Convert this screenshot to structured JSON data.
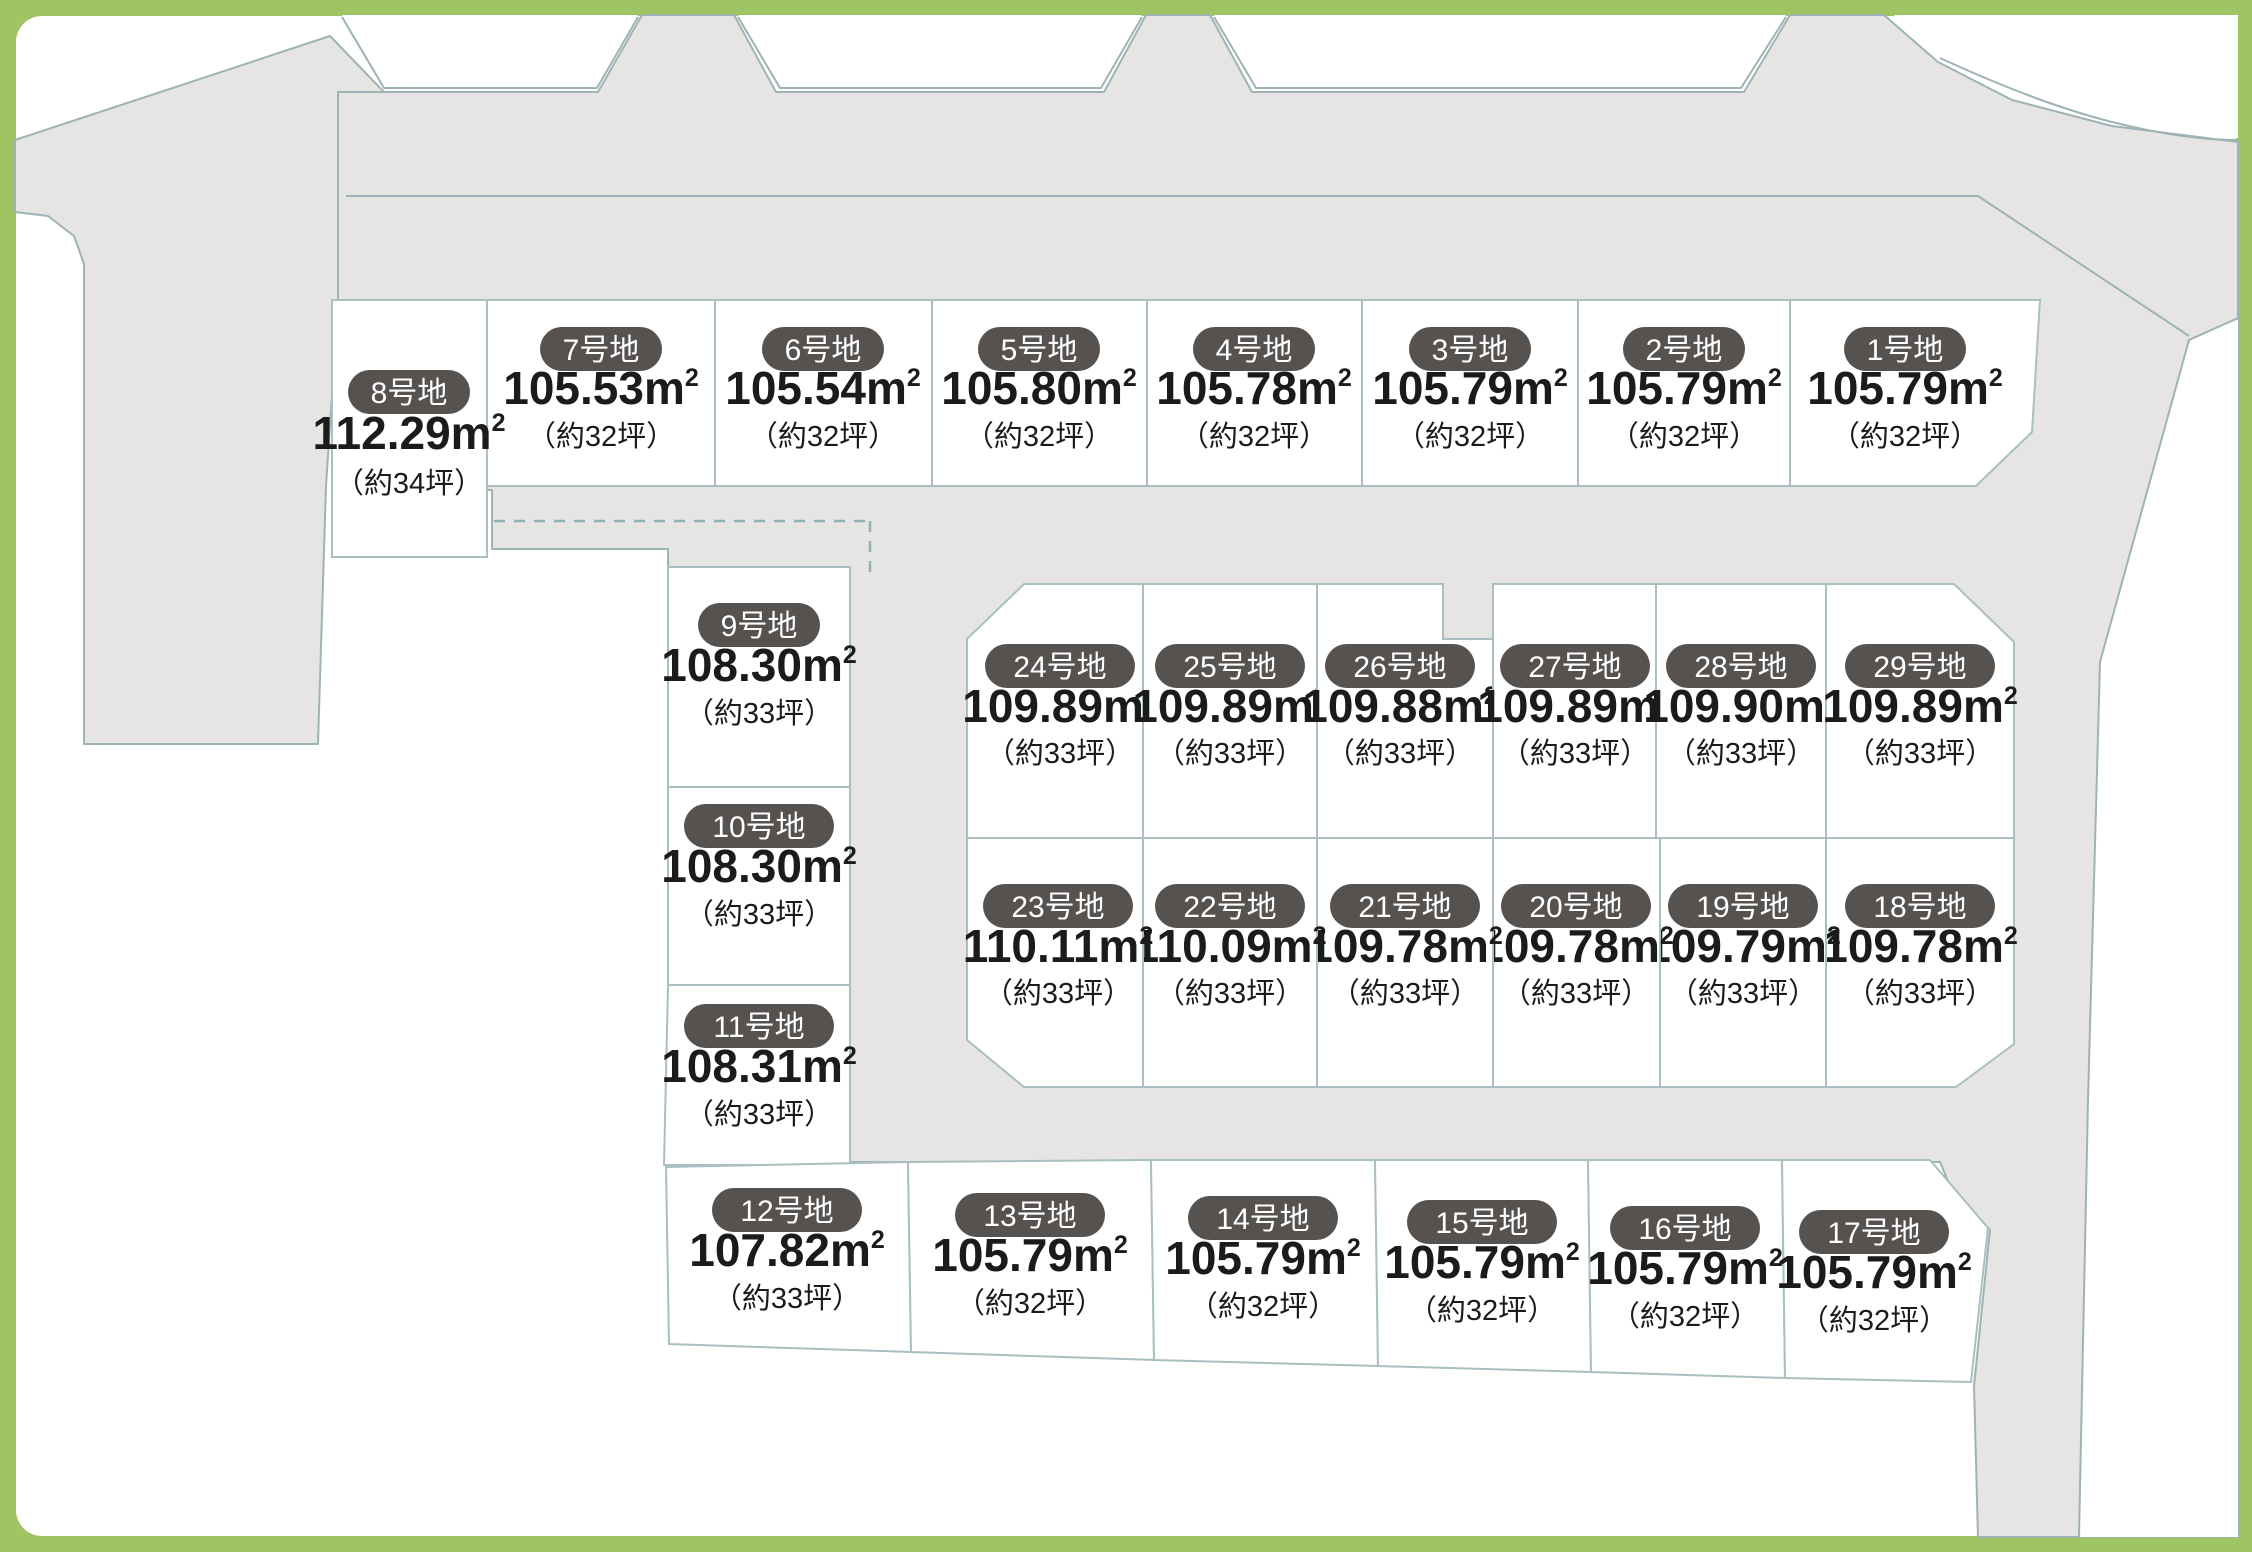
{
  "map": {
    "colors": {
      "frame_green": "#9ec464",
      "road_fill": "#e6e5e3",
      "road_stroke": "#9db3b5",
      "lot_fill": "#ffffff",
      "lot_stroke": "#a9bfc1",
      "badge_fill": "#555250",
      "badge_text": "#ffffff",
      "text": "#1b1b1b"
    },
    "unit_suffix": "m",
    "unit_sup": "2",
    "lots": [
      {
        "id": 1,
        "label": "1号地",
        "area": "105.79",
        "tsubo": "（約32坪）"
      },
      {
        "id": 2,
        "label": "2号地",
        "area": "105.79",
        "tsubo": "（約32坪）"
      },
      {
        "id": 3,
        "label": "3号地",
        "area": "105.79",
        "tsubo": "（約32坪）"
      },
      {
        "id": 4,
        "label": "4号地",
        "area": "105.78",
        "tsubo": "（約32坪）"
      },
      {
        "id": 5,
        "label": "5号地",
        "area": "105.80",
        "tsubo": "（約32坪）"
      },
      {
        "id": 6,
        "label": "6号地",
        "area": "105.54",
        "tsubo": "（約32坪）"
      },
      {
        "id": 7,
        "label": "7号地",
        "area": "105.53",
        "tsubo": "（約32坪）"
      },
      {
        "id": 8,
        "label": "8号地",
        "area": "112.29",
        "tsubo": "（約34坪）"
      },
      {
        "id": 9,
        "label": "9号地",
        "area": "108.30",
        "tsubo": "（約33坪）"
      },
      {
        "id": 10,
        "label": "10号地",
        "area": "108.30",
        "tsubo": "（約33坪）"
      },
      {
        "id": 11,
        "label": "11号地",
        "area": "108.31",
        "tsubo": "（約33坪）"
      },
      {
        "id": 12,
        "label": "12号地",
        "area": "107.82",
        "tsubo": "（約33坪）"
      },
      {
        "id": 13,
        "label": "13号地",
        "area": "105.79",
        "tsubo": "（約32坪）"
      },
      {
        "id": 14,
        "label": "14号地",
        "area": "105.79",
        "tsubo": "（約32坪）"
      },
      {
        "id": 15,
        "label": "15号地",
        "area": "105.79",
        "tsubo": "（約32坪）"
      },
      {
        "id": 16,
        "label": "16号地",
        "area": "105.79",
        "tsubo": "（約32坪）"
      },
      {
        "id": 17,
        "label": "17号地",
        "area": "105.79",
        "tsubo": "（約32坪）"
      },
      {
        "id": 18,
        "label": "18号地",
        "area": "109.78",
        "tsubo": "（約33坪）"
      },
      {
        "id": 19,
        "label": "19号地",
        "area": "109.79",
        "tsubo": "（約33坪）"
      },
      {
        "id": 20,
        "label": "20号地",
        "area": "109.78",
        "tsubo": "（約33坪）"
      },
      {
        "id": 21,
        "label": "21号地",
        "area": "109.78",
        "tsubo": "（約33坪）"
      },
      {
        "id": 22,
        "label": "22号地",
        "area": "110.09",
        "tsubo": "（約33坪）"
      },
      {
        "id": 23,
        "label": "23号地",
        "area": "110.11",
        "tsubo": "（約33坪）"
      },
      {
        "id": 24,
        "label": "24号地",
        "area": "109.89",
        "tsubo": "（約33坪）"
      },
      {
        "id": 25,
        "label": "25号地",
        "area": "109.89",
        "tsubo": "（約33坪）"
      },
      {
        "id": 26,
        "label": "26号地",
        "area": "109.88",
        "tsubo": "（約33坪）"
      },
      {
        "id": 27,
        "label": "27号地",
        "area": "109.89",
        "tsubo": "（約33坪）"
      },
      {
        "id": 28,
        "label": "28号地",
        "area": "109.90",
        "tsubo": "（約33坪）"
      },
      {
        "id": 29,
        "label": "29号地",
        "area": "109.89",
        "tsubo": "（約33坪）"
      }
    ]
  }
}
